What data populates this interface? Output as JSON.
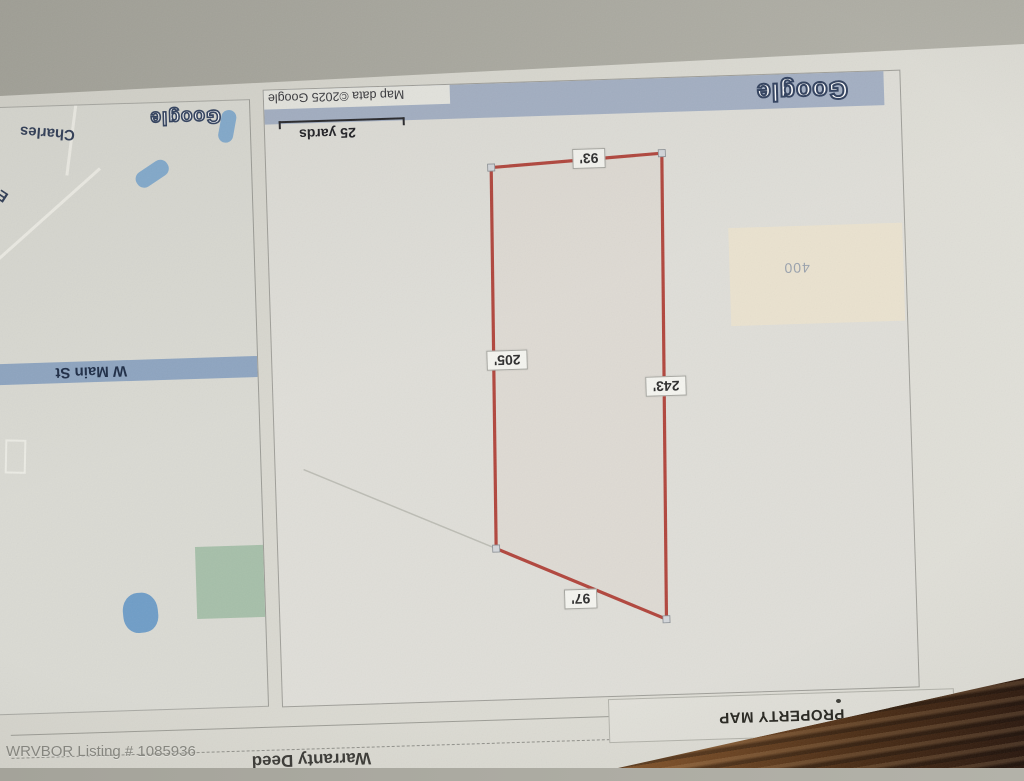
{
  "photo_overlay": {
    "watermark": "WRVBOR Listing # 1085936"
  },
  "page": {
    "dimension_note": "*Lot Dimensions are Estimated",
    "section_title": "PROPERTY MAP",
    "deed_label": "Warranty Deed"
  },
  "property_map": {
    "brand": "Google",
    "attribution": "Map data ©2025 Google",
    "scale_label": "25 yards",
    "parcel_label": "400",
    "dimensions": {
      "top": "93'",
      "left": "205'",
      "right": "243'",
      "bottom_diagonal": "97'"
    },
    "boundary_color": "#b1453c"
  },
  "locator_map": {
    "brand": "Google",
    "street_main": "W Main St",
    "street_charles": "Charles",
    "street_el": "El"
  }
}
